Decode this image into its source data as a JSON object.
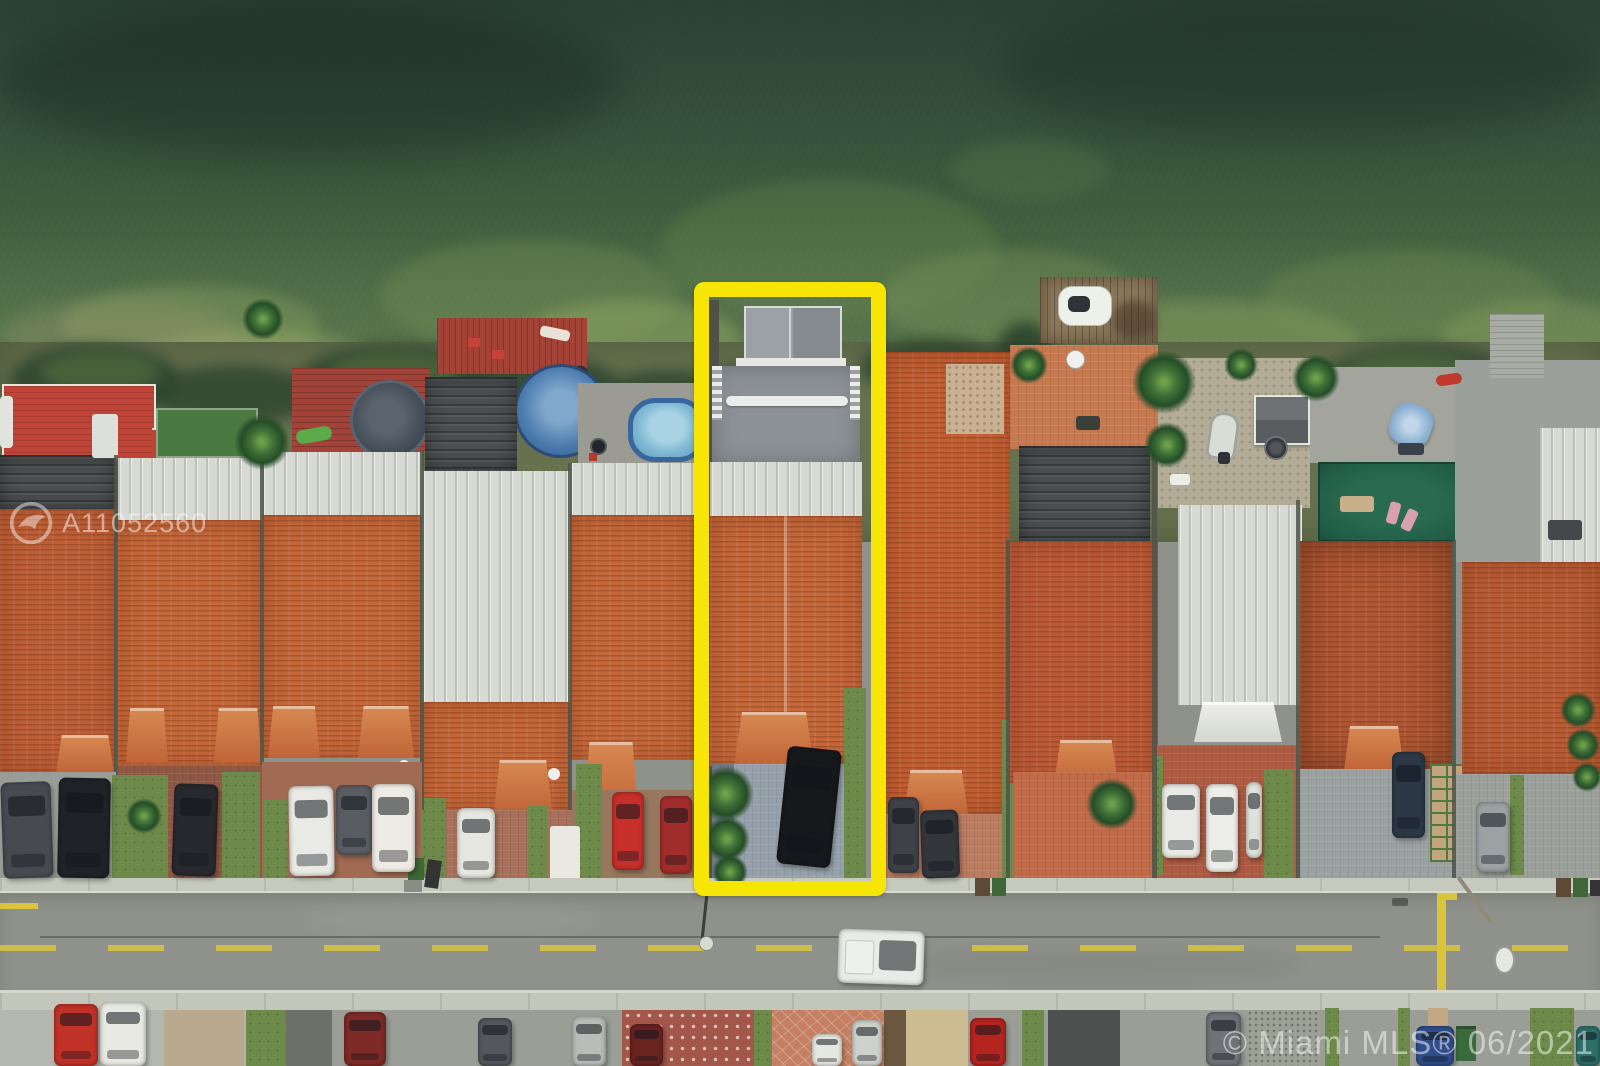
{
  "image": {
    "type": "aerial-drone-photograph",
    "width": 1600,
    "height": 1066,
    "description": "Top-down aerial view of a row of waterfront townhouses on a green lake; one lot is outlined with a thick yellow rectangle; street with parked cars below"
  },
  "watermarks": {
    "listing_id": "A11052560",
    "mls_credit": "© Miami MLS® 06/2021",
    "logo_icon": "mls-bird-circle-logo",
    "text_color": "rgba(255,255,255,0.5)"
  },
  "annotation": {
    "shape": "rectangle",
    "highlight_color": "#F7E505",
    "box": {
      "left": 694,
      "top": 282,
      "width": 192,
      "height": 614,
      "stroke": 15
    }
  },
  "palette": {
    "water_deep": "#2B4133",
    "water_shallow": "#5F7A50",
    "algae": "#8CA167",
    "tile_roof": "#C4683A",
    "metal_roof": "#D7D9D3",
    "shingle_roof": "#4B4E50",
    "asphalt": "#8F928B",
    "sidewalk": "#C6C9BD",
    "lane_yellow": "#D9C43C",
    "grass": "#6D8A4A",
    "turf": "#4A7A42",
    "putting_green": "#215C46",
    "deck_red": "#A34237",
    "dock_wood": "#8C795C",
    "pool_blue": "#7FB9D4",
    "subject_driveway_pavers": "#95A0AA"
  },
  "scene": {
    "landmarks": [
      "lake-water",
      "algae-patches",
      "shoreline-weeds",
      "wooden-dock-with-jetski",
      "red-deck",
      "trampoline",
      "above-ground-pool",
      "oval-pool",
      "putting-green",
      "patio-umbrella",
      "storage-sheds",
      "boat-on-stand",
      "street-lamp",
      "speed-hump-yellow-line"
    ],
    "vehicles_driveway": [
      {
        "name": "dark-suv-house1-left",
        "x": 2,
        "y": 782,
        "w": 50,
        "h": 96,
        "color": "#474B50",
        "rot": -2
      },
      {
        "name": "black-suv-house1",
        "x": 58,
        "y": 778,
        "w": 52,
        "h": 100,
        "color": "#1F2226",
        "rot": 1
      },
      {
        "name": "black-sedan-house2",
        "x": 173,
        "y": 784,
        "w": 44,
        "h": 92,
        "color": "#27292E",
        "rot": 2
      },
      {
        "name": "white-boxvan-house3",
        "x": 289,
        "y": 786,
        "w": 45,
        "h": 90,
        "color": "#E9EAE5",
        "rot": -1
      },
      {
        "name": "gray-sedan-house3",
        "x": 336,
        "y": 785,
        "w": 36,
        "h": 70,
        "color": "#595D63",
        "rot": 0
      },
      {
        "name": "white-van-house3",
        "x": 372,
        "y": 784,
        "w": 43,
        "h": 88,
        "color": "#EDEBE3",
        "rot": 0
      },
      {
        "name": "white-car-house4",
        "x": 457,
        "y": 808,
        "w": 38,
        "h": 70,
        "color": "#E6E7E1",
        "rot": 0
      },
      {
        "name": "red-car-house5-left",
        "x": 612,
        "y": 792,
        "w": 32,
        "h": 78,
        "color": "#C62F2A",
        "rot": 0
      },
      {
        "name": "dark-red-car-house5",
        "x": 660,
        "y": 796,
        "w": 32,
        "h": 78,
        "color": "#A22E2B",
        "rot": 0
      },
      {
        "name": "black-car-subject-driveway",
        "x": 782,
        "y": 748,
        "w": 54,
        "h": 118,
        "color": "#16181C",
        "rot": 6
      },
      {
        "name": "dark-suv-house7",
        "x": 888,
        "y": 797,
        "w": 31,
        "h": 76,
        "color": "#3E4146",
        "rot": 0
      },
      {
        "name": "dark-sedan-house7",
        "x": 921,
        "y": 810,
        "w": 38,
        "h": 68,
        "color": "#33363B",
        "rot": -2
      },
      {
        "name": "white-pickup-house9",
        "x": 1162,
        "y": 784,
        "w": 38,
        "h": 74,
        "color": "#E9EAE5",
        "rot": 0
      },
      {
        "name": "white-sedan-house9",
        "x": 1206,
        "y": 784,
        "w": 32,
        "h": 88,
        "color": "#EDEEE9",
        "rot": 0
      },
      {
        "name": "white-car-house9-partial",
        "x": 1246,
        "y": 782,
        "w": 16,
        "h": 76,
        "color": "#DFE1DB",
        "rot": 0
      },
      {
        "name": "navy-car-house10",
        "x": 1392,
        "y": 752,
        "w": 33,
        "h": 86,
        "color": "#2C3845",
        "rot": 0
      },
      {
        "name": "silver-car-house10",
        "x": 1476,
        "y": 802,
        "w": 34,
        "h": 70,
        "color": "#9CA2A4",
        "rot": 0
      }
    ],
    "vehicles_street": [
      {
        "name": "white-pickup-truck-street",
        "x": 838,
        "y": 930,
        "w": 86,
        "h": 54,
        "color": "#E9EBE6",
        "rot": 2,
        "kind": "truck"
      }
    ],
    "vehicles_bottom": [
      {
        "name": "red-car-bottom-1",
        "x": 54,
        "y": 1004,
        "w": 44,
        "h": 62,
        "color": "#C03127",
        "rot": 0
      },
      {
        "name": "white-car-bottom-1",
        "x": 100,
        "y": 1002,
        "w": 46,
        "h": 64,
        "color": "#E8E9E3",
        "rot": 0
      },
      {
        "name": "maroon-car-bottom-1",
        "x": 344,
        "y": 1012,
        "w": 42,
        "h": 54,
        "color": "#7E2A26",
        "rot": 0
      },
      {
        "name": "gray-car-bottom",
        "x": 478,
        "y": 1018,
        "w": 34,
        "h": 48,
        "color": "#54575B",
        "rot": 0
      },
      {
        "name": "silver-car-bottom-1",
        "x": 572,
        "y": 1016,
        "w": 34,
        "h": 50,
        "color": "#B9BCB9",
        "rot": 0
      },
      {
        "name": "maroon-car-bottom-2",
        "x": 630,
        "y": 1024,
        "w": 33,
        "h": 42,
        "color": "#6B2320",
        "rot": 0
      },
      {
        "name": "white-car-bottom-2",
        "x": 812,
        "y": 1034,
        "w": 30,
        "h": 32,
        "color": "#E7E8E2",
        "rot": 0
      },
      {
        "name": "silver-car-bottom-2",
        "x": 852,
        "y": 1020,
        "w": 30,
        "h": 46,
        "color": "#CFD1CC",
        "rot": 0
      },
      {
        "name": "red-car-bottom-2",
        "x": 970,
        "y": 1018,
        "w": 36,
        "h": 48,
        "color": "#B5251F",
        "rot": 0
      },
      {
        "name": "gray-suv-bottom",
        "x": 1206,
        "y": 1012,
        "w": 35,
        "h": 54,
        "color": "#6F7276",
        "rot": 0
      },
      {
        "name": "blue-car-bottom",
        "x": 1416,
        "y": 1026,
        "w": 38,
        "h": 40,
        "color": "#2F4D8A",
        "rot": 0
      },
      {
        "name": "teal-car-bottom",
        "x": 1576,
        "y": 1026,
        "w": 24,
        "h": 40,
        "color": "#2E6F6A",
        "rot": 0
      }
    ]
  }
}
